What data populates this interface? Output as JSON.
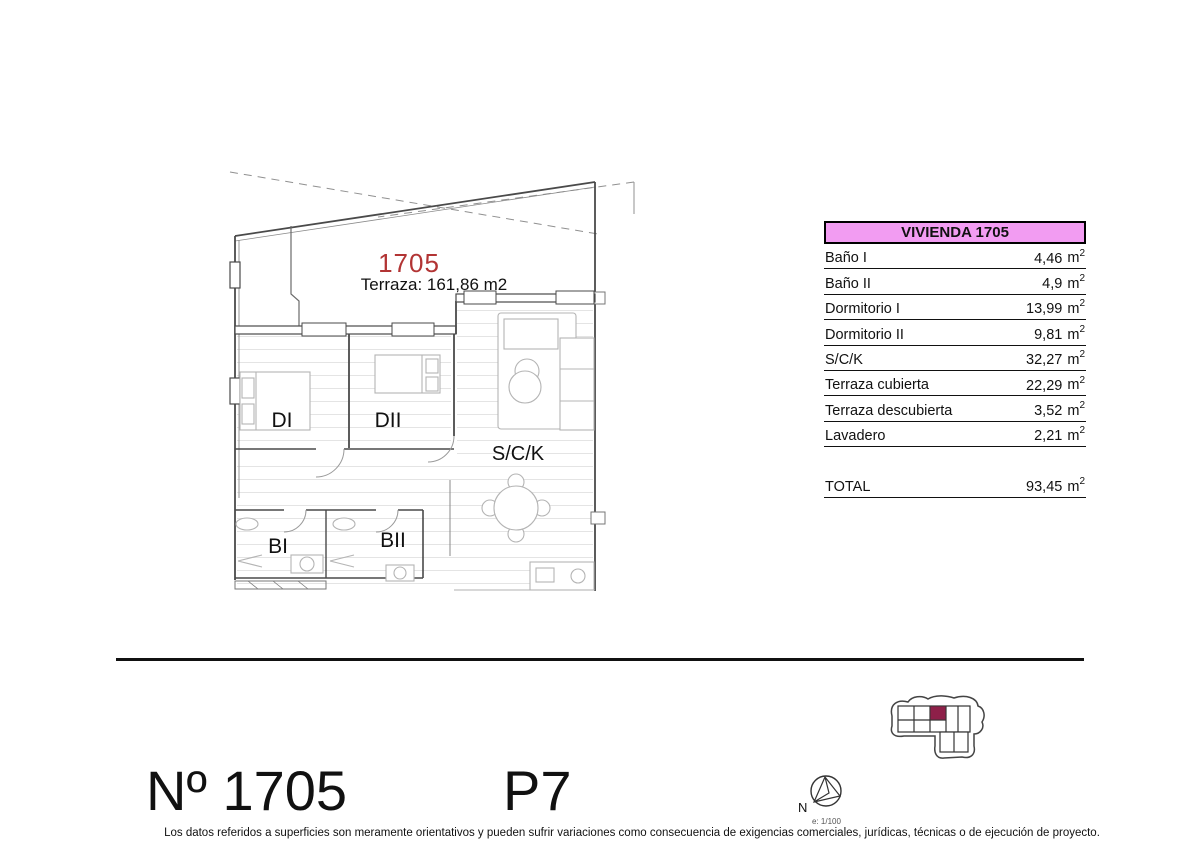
{
  "plan": {
    "unit_number": "1705",
    "terrace_label": "Terraza: 161,86 m2",
    "rooms": {
      "di": "DI",
      "dii": "DII",
      "sck": "S/C/K",
      "bi": "BI",
      "bii": "BII"
    }
  },
  "table": {
    "header": "VIVIENDA 1705",
    "unit": {
      "base": "m",
      "sup": "2"
    },
    "rows": [
      {
        "label": "Baño I",
        "value": "4,46"
      },
      {
        "label": "Baño II",
        "value": "4,9"
      },
      {
        "label": "Dormitorio I",
        "value": "13,99"
      },
      {
        "label": "Dormitorio II",
        "value": "9,81"
      },
      {
        "label": "S/C/K",
        "value": "32,27"
      },
      {
        "label": "Terraza cubierta",
        "value": "22,29"
      },
      {
        "label": "Terraza descubierta",
        "value": "3,52"
      },
      {
        "label": "Lavadero",
        "value": "2,21"
      }
    ],
    "total": {
      "label": "TOTAL",
      "value": "93,45"
    }
  },
  "bottom": {
    "unit_label": "Nº 1705",
    "floor_label": "P7",
    "compass": {
      "north": "N",
      "scale": "e: 1/100"
    }
  },
  "footer": {
    "disclaimer": "Los datos referidos a superficies son meramente orientativos y pueden sufrir variaciones como consecuencia de exigencias comerciales, jurídicas, técnicas o de ejecución de proyecto."
  },
  "colors": {
    "header_pink": "#f29cf2",
    "unit_red": "#b23434",
    "building_highlight": "#8e2049",
    "line_black": "#111111"
  }
}
